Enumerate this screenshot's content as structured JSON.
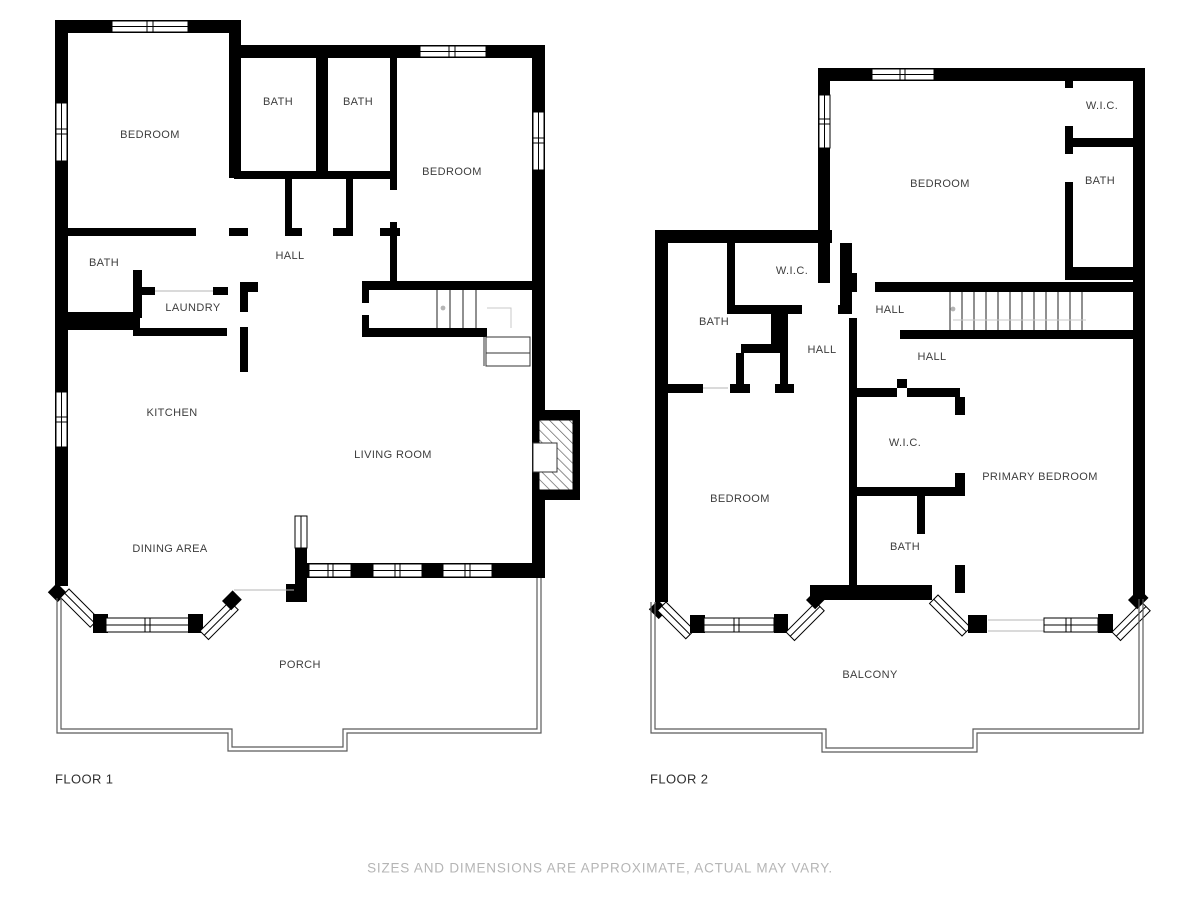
{
  "floor1": {
    "name": "FLOOR 1",
    "rooms": [
      {
        "label": "BEDROOM"
      },
      {
        "label": "BATH"
      },
      {
        "label": "BATH"
      },
      {
        "label": "BEDROOM"
      },
      {
        "label": "BATH"
      },
      {
        "label": "HALL"
      },
      {
        "label": "LAUNDRY"
      },
      {
        "label": "KITCHEN"
      },
      {
        "label": "LIVING ROOM"
      },
      {
        "label": "DINING AREA"
      },
      {
        "label": "PORCH"
      }
    ]
  },
  "floor2": {
    "name": "FLOOR 2",
    "rooms": [
      {
        "label": "BEDROOM"
      },
      {
        "label": "W.I.C."
      },
      {
        "label": "BATH"
      },
      {
        "label": "W.I.C."
      },
      {
        "label": "BATH"
      },
      {
        "label": "HALL"
      },
      {
        "label": "HALL"
      },
      {
        "label": "HALL"
      },
      {
        "label": "BEDROOM"
      },
      {
        "label": "W.I.C."
      },
      {
        "label": "BATH"
      },
      {
        "label": "PRIMARY BEDROOM"
      },
      {
        "label": "BALCONY"
      }
    ]
  },
  "disclaimer": "SIZES AND DIMENSIONS ARE APPROXIMATE, ACTUAL MAY VARY.",
  "colors": {
    "wall": "#000000",
    "room_label": "#3d3d3d",
    "floor_label": "#2f2f2f",
    "outline": "#5a5a5a",
    "disclaimer": "#b5b5b5"
  }
}
